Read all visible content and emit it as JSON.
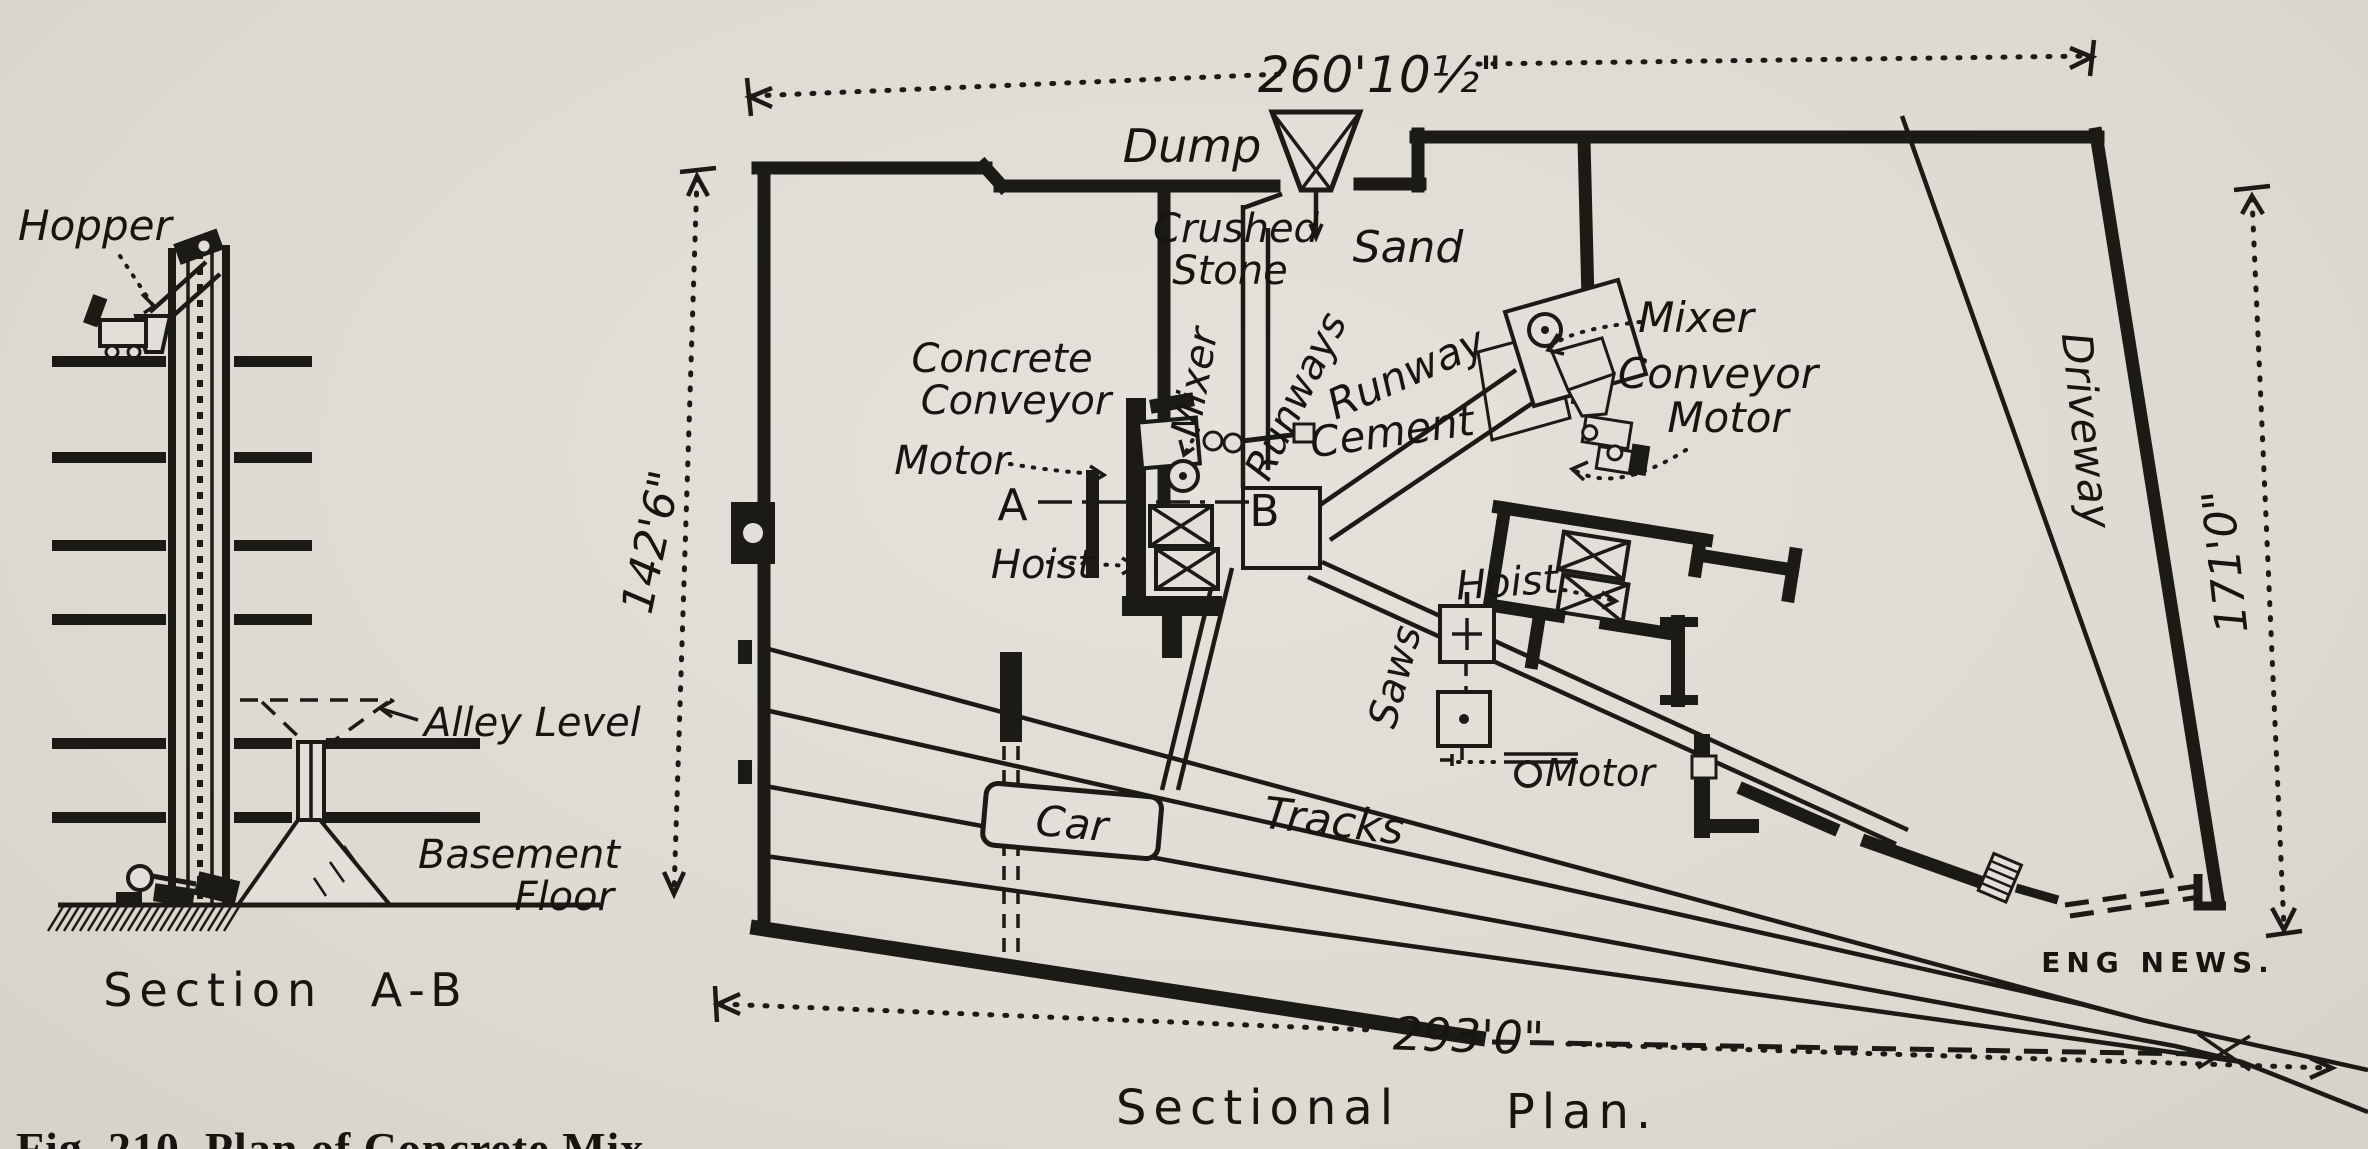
{
  "section_ab": {
    "labels": {
      "hopper": "Hopper",
      "alley_level": "Alley Level",
      "basement_line1": "Basement",
      "basement_line2": "Floor"
    },
    "caption": "Section A-B"
  },
  "plan": {
    "caption_word1": "Sectional",
    "caption_word2": "Plan.",
    "dimensions": {
      "top": "260'10½\"",
      "left": "142'6\"",
      "right": "171'0\"",
      "bottom": "293'0\""
    },
    "labels": {
      "dump": "Dump",
      "crushed_line1": "Crushed",
      "crushed_line2": "Stone",
      "sand": "Sand",
      "concrete_conveyor_line1": "Concrete",
      "concrete_conveyor_line2": "Conveyor",
      "motor_left": "Motor",
      "mixer_left": "Mixer",
      "runways": "Runways",
      "runway": "Runway",
      "cement": "Cement",
      "mixer_right": "Mixer",
      "conveyor_motor_line1": "Conveyor",
      "conveyor_motor_line2": "Motor",
      "hoist_left": "Hoist",
      "hoist_right": "Hoist",
      "point_a": "A",
      "point_b": "B",
      "saws": "Saws",
      "saw_motor": "Motor",
      "car": "Car",
      "tracks": "Tracks",
      "driveway": "Driveway",
      "credit": "ENG NEWS."
    }
  },
  "page": {
    "figure_caption_fragment": "Fig. 210.   Plan of Concrete Mix"
  }
}
